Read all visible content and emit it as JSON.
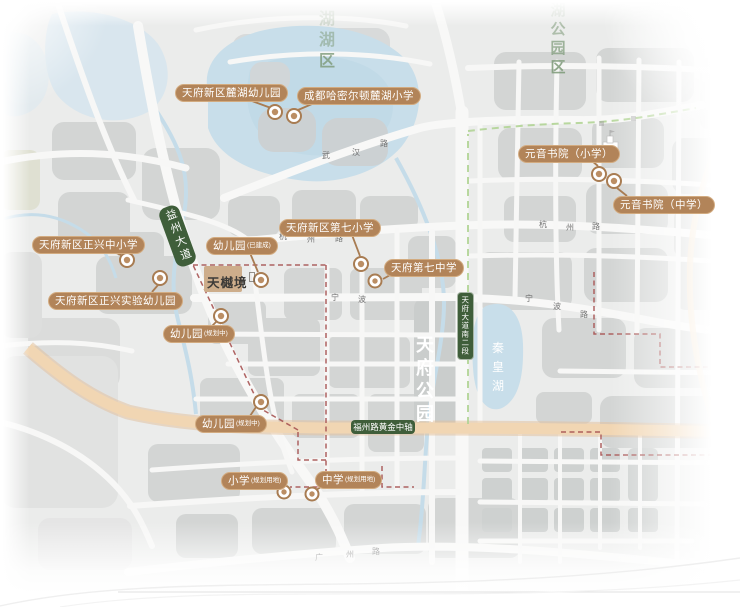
{
  "map": {
    "project": {
      "name": "天樾境",
      "label": {
        "x": 207,
        "y": 272
      },
      "block": {
        "x": 204,
        "y": 266,
        "w": 38,
        "h": 26
      }
    },
    "schools": [
      {
        "id": "luhu-kindergarten",
        "name": "天府新区麓湖幼儿园",
        "suffix": "",
        "label": {
          "x": 175,
          "y": 84
        },
        "pin": {
          "x": 275,
          "y": 112,
          "r": 7
        },
        "leader": [
          252,
          101,
          271,
          108
        ]
      },
      {
        "id": "hamilton-luhu-primary",
        "name": "成都哈密尔顿麓湖小学",
        "suffix": "",
        "label": {
          "x": 297,
          "y": 87
        },
        "pin": {
          "x": 294,
          "y": 116,
          "r": 7
        },
        "leader": [
          312,
          104,
          298,
          110
        ]
      },
      {
        "id": "yuanyin-academy-primary",
        "name": "元音书院（小学）",
        "suffix": "",
        "label": {
          "x": 518,
          "y": 145
        },
        "pin": {
          "x": 599,
          "y": 174,
          "r": 7
        },
        "leader": [
          592,
          161,
          598,
          166
        ]
      },
      {
        "id": "yuanyin-academy-middle",
        "name": "元音书院（中学）",
        "suffix": "",
        "label": {
          "x": 613,
          "y": 196
        },
        "pin": {
          "x": 614,
          "y": 181,
          "r": 7
        },
        "leader": [
          627,
          196,
          617,
          188
        ]
      },
      {
        "id": "tianfu-7th-primary",
        "name": "天府新区第七小学",
        "suffix": "",
        "label": {
          "x": 279,
          "y": 219
        },
        "pin": {
          "x": 361,
          "y": 264,
          "r": 7
        },
        "leader": [
          352,
          235,
          360,
          256
        ]
      },
      {
        "id": "tianfu-7th-middle",
        "name": "天府第七中学",
        "suffix": "",
        "label": {
          "x": 384,
          "y": 259
        },
        "pin": {
          "x": 375,
          "y": 281,
          "r": 6.5
        },
        "leader": [
          392,
          274,
          383,
          279
        ]
      },
      {
        "id": "zhengxing-primary-middle",
        "name": "天府新区正兴中小学",
        "suffix": "",
        "label": {
          "x": 32,
          "y": 236
        },
        "pin": {
          "x": 127,
          "y": 260,
          "r": 7
        },
        "leader": [
          114,
          252,
          121,
          255
        ]
      },
      {
        "id": "zhengxing-experimental-kindergarten",
        "name": "天府新区正兴实验幼儿园",
        "suffix": "",
        "label": {
          "x": 48,
          "y": 292
        },
        "pin": {
          "x": 160,
          "y": 278,
          "r": 7
        },
        "leader": [
          152,
          292,
          158,
          285
        ]
      },
      {
        "id": "kindergarten-built",
        "name": "幼儿园",
        "suffix": "(已建成)",
        "label": {
          "x": 206,
          "y": 237
        },
        "pin": {
          "x": 261,
          "y": 280,
          "r": 7
        },
        "leader": [
          250,
          253,
          258,
          272
        ]
      },
      {
        "id": "kindergarten-planned-west",
        "name": "幼儿园",
        "suffix": "(规划中)",
        "label": {
          "x": 163,
          "y": 325
        },
        "pin": {
          "x": 221,
          "y": 316,
          "r": 7
        },
        "leader": [
          212,
          326,
          217,
          321
        ]
      },
      {
        "id": "kindergarten-planned-south",
        "name": "幼儿园",
        "suffix": "(规划中)",
        "label": {
          "x": 195,
          "y": 415
        },
        "pin": {
          "x": 261,
          "y": 402,
          "r": 7
        },
        "leader": [
          250,
          416,
          256,
          407
        ]
      },
      {
        "id": "primary-planned-site",
        "name": "小学",
        "suffix": "(规划用地)",
        "label": {
          "x": 221,
          "y": 472
        },
        "pin": {
          "x": 284,
          "y": 492,
          "r": 6.5
        },
        "leader": [
          272,
          487,
          280,
          489
        ]
      },
      {
        "id": "middle-planned-site",
        "name": "中学",
        "suffix": "(规划用地)",
        "label": {
          "x": 315,
          "y": 471
        },
        "pin": {
          "x": 312,
          "y": 494,
          "r": 6.5
        },
        "leader": [
          321,
          487,
          316,
          490
        ]
      }
    ],
    "road_badges": [
      {
        "id": "yizhou-avenue",
        "text": "益州大道",
        "x": 177,
        "y": 236,
        "w": 21,
        "h": 62,
        "rotate": -20,
        "vertical": true,
        "fontSize": 11,
        "letterSpacing": 3,
        "radius": 8,
        "border": false
      },
      {
        "id": "tianfu-avenue-south-2",
        "text": "天府大道南二段",
        "x": 464,
        "y": 325,
        "w": 15,
        "h": 66,
        "rotate": 0,
        "vertical": true,
        "fontSize": 7.5,
        "letterSpacing": 1,
        "radius": 4,
        "border": true
      },
      {
        "id": "fuzhou-road-golden-axis",
        "text": "福州路黄金中轴",
        "x": 383,
        "y": 427,
        "w": 64,
        "h": 14,
        "rotate": 0,
        "vertical": false,
        "fontSize": 8.5,
        "letterSpacing": 0,
        "radius": 4,
        "border": false
      }
    ],
    "area_labels": [
      {
        "id": "lake-district",
        "chars": [
          {
            "c": "湖",
            "o": 0.25
          },
          {
            "c": "湖",
            "o": 0.5
          },
          {
            "c": "区",
            "o": 0.8
          }
        ],
        "x": 327,
        "y": 12,
        "step": 21,
        "size": 16,
        "color": "#7d9a78",
        "bold": true
      },
      {
        "id": "park-district",
        "chars": [
          {
            "c": "湖",
            "o": 0.22
          },
          {
            "c": "公",
            "o": 0.55
          },
          {
            "c": "园",
            "o": 0.7
          },
          {
            "c": "区",
            "o": 0.85
          }
        ],
        "x": 558,
        "y": 3,
        "step": 19,
        "size": 15,
        "color": "#7d9a78",
        "bold": true
      },
      {
        "id": "tianfu-park",
        "chars": [
          {
            "c": "天",
            "o": 1
          },
          {
            "c": "府",
            "o": 1
          },
          {
            "c": "公",
            "o": 1
          },
          {
            "c": "园",
            "o": 1
          }
        ],
        "x": 425,
        "y": 336,
        "step": 23,
        "size": 18,
        "color": "#ffffff",
        "bold": true
      },
      {
        "id": "qinhuang-lake",
        "chars": [
          {
            "c": "秦",
            "o": 1
          },
          {
            "c": "皇",
            "o": 1
          },
          {
            "c": "湖",
            "o": 1
          }
        ],
        "x": 498,
        "y": 342,
        "step": 19,
        "size": 12,
        "color": "#ffffff",
        "bold": false
      }
    ],
    "road_names": [
      {
        "id": "wuhan-road",
        "text": "武汉路",
        "chars": [
          [
            322,
            152
          ],
          [
            352,
            149
          ],
          [
            380,
            140
          ]
        ]
      },
      {
        "id": "hangzhou-road-west",
        "text": "杭州路",
        "chars": [
          [
            279,
            233
          ],
          [
            307,
            236
          ],
          [
            335,
            235
          ]
        ]
      },
      {
        "id": "hangzhou-road-east",
        "text": "杭州路",
        "chars": [
          [
            539,
            221
          ],
          [
            566,
            224
          ],
          [
            592,
            223
          ]
        ]
      },
      {
        "id": "ningbo-road-west",
        "text": "宁波",
        "chars": [
          [
            331,
            294
          ],
          [
            358,
            296
          ]
        ]
      },
      {
        "id": "ningbo-road-east",
        "text": "宁波路",
        "chars": [
          [
            525,
            295
          ],
          [
            553,
            303
          ],
          [
            580,
            311
          ]
        ]
      },
      {
        "id": "guangzhou-road",
        "text": "广州路",
        "chars": [
          [
            315,
            554
          ],
          [
            346,
            551
          ],
          [
            372,
            548
          ]
        ]
      }
    ],
    "colors": {
      "bubble_bg": "#b28459",
      "bubble_border": "#d2ab80",
      "bubble_text": "#ffffff",
      "badge_green": "#3f5e3a",
      "pin_ring": "#a87c52",
      "pin_fill": "#bb8e64",
      "boundary_red": "#9c3f3e",
      "path_green": "#a8cf8a",
      "road_gold": "#f0d2ab",
      "lake_blue": "#c2dbe8",
      "parcel_gray": "#cfd1d0"
    }
  }
}
